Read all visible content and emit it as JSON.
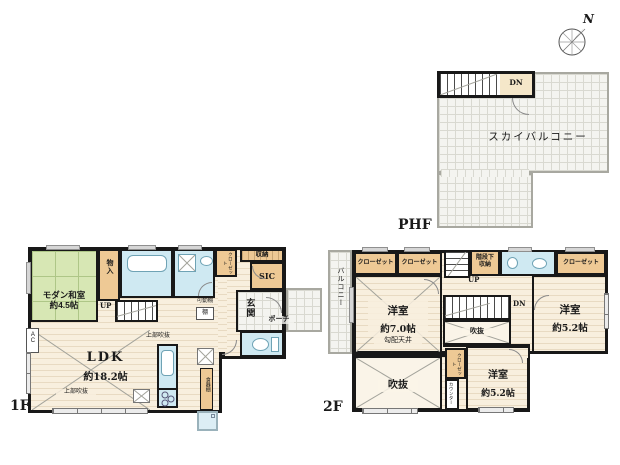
{
  "palette": {
    "wall": "#181818",
    "tatami_green": "#d7e7b4",
    "wet_blue": "#cfe9f2",
    "storage_tan": "#eec995",
    "wood_floor": "#f8efde",
    "tile_gray": "#f4f4f0"
  },
  "compass": {
    "north_label": "N"
  },
  "phf": {
    "floor_label": "PHF",
    "sky_balcony_label": "スカイバルコニー",
    "stairs_dn_label": "DN"
  },
  "f1": {
    "floor_label": "1F",
    "washitsu_name": "モダン和室",
    "washitsu_size": "約4.5帖",
    "monoire_label": "物入",
    "closet_label": "クローゼット",
    "shuno_label": "収納",
    "sic_label": "SIC",
    "genkan_label": "玄関",
    "porch_label": "ポーチ",
    "movable_shelf_label": "可動棚",
    "shelf_label": "棚",
    "stairs_up_label": "UP",
    "stair_void_label": "上部吹抜",
    "ldk_name": "LDK",
    "ldk_size": "約18.2帖",
    "ldk_void_label": "上部吹抜",
    "cupboard_label": "食器棚",
    "ac_label": "AC"
  },
  "f2": {
    "floor_label": "2F",
    "balcony_label": "バルコニー",
    "closet_a_label": "クローゼット",
    "closet_b_label": "クローゼット",
    "closet_c_label": "クローゼット",
    "closet_d_label": "クローゼット",
    "room70_name": "洋室",
    "room70_size": "約7.0帖",
    "sloped_ceiling_label": "勾配天井",
    "stairs_up_label": "UP",
    "stairs_dn_label": "DN",
    "stair_storage_line1": "階段下",
    "stair_storage_line2": "収納",
    "void_small_label": "吹抜",
    "void_large_label": "吹抜",
    "counter_label": "カウンター",
    "room52a_name": "洋室",
    "room52a_size": "約5.2帖",
    "room52b_name": "洋室",
    "room52b_size": "約5.2帖"
  }
}
